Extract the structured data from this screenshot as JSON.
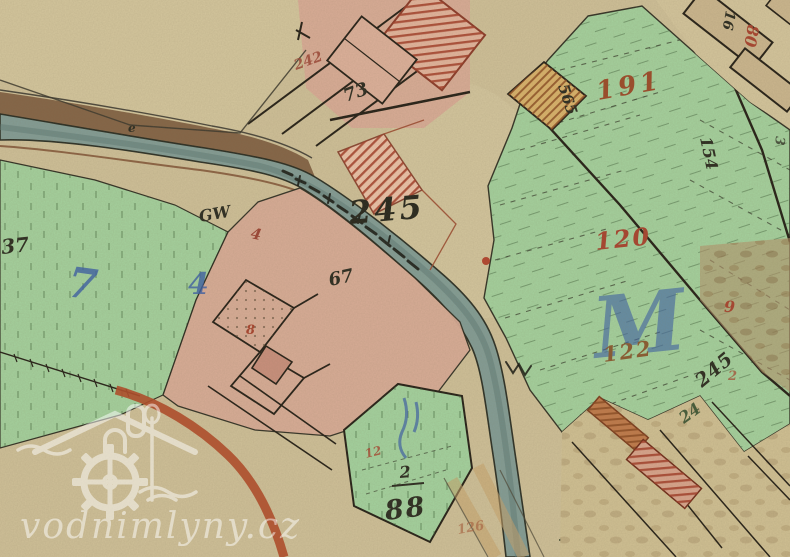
{
  "watermark": {
    "text": "vodnimlyny.cz",
    "icon": "watermill-logo"
  },
  "palette": {
    "paper": "#cfc098",
    "paper_light": "#d6c9a0",
    "meadow_green": "#a3d29e",
    "farm_pink": "#d9ab96",
    "building_pink": "#e3b49c",
    "stream_teal": "#7e9b95",
    "road_brown": "#7b5a3d",
    "road_red": "#b14a28",
    "barn_tan": "#cbb68e",
    "hatch_red": "#a33d28",
    "hatch_orange": "#8a4a20",
    "ink_black": "#2b2b20",
    "ink_red": "#a8432e",
    "ink_brown": "#8a5a30",
    "ink_blue": "#3a5fa8",
    "ink_green": "#2c4a2a"
  },
  "labels": [
    {
      "name": "parcel-245-center",
      "text": "245",
      "x": 350,
      "y": 224,
      "size": 32,
      "color": "#26261c",
      "rot": -5,
      "spacing": 3
    },
    {
      "name": "house-73",
      "text": "73",
      "x": 346,
      "y": 102,
      "size": 18,
      "color": "#2b2b20",
      "rot": -20
    },
    {
      "name": "red-242",
      "text": "242",
      "x": 296,
      "y": 70,
      "size": 14,
      "color": "#9c4434",
      "rot": -20,
      "opacity": 0.85
    },
    {
      "name": "building-565",
      "text": "565",
      "x": 558,
      "y": 86,
      "size": 15,
      "color": "#2b2b20",
      "rot": 72
    },
    {
      "name": "corner-16",
      "text": "16",
      "x": 726,
      "y": 10,
      "size": 14,
      "color": "#2b2b20",
      "rot": 100
    },
    {
      "name": "red-80",
      "text": "80",
      "x": 748,
      "y": 24,
      "size": 16,
      "color": "#a8432e",
      "rot": 100
    },
    {
      "name": "parcel-191",
      "text": "191",
      "x": 598,
      "y": 100,
      "size": 26,
      "color": "#9c4a28",
      "rot": -10,
      "spacing": 4
    },
    {
      "name": "parcel-154",
      "text": "154",
      "x": 700,
      "y": 138,
      "size": 16,
      "color": "#2b2b20",
      "rot": 78
    },
    {
      "name": "edge-3",
      "text": "3",
      "x": 776,
      "y": 136,
      "size": 13,
      "color": "#2b2b20",
      "rot": 95,
      "opacity": 0.75
    },
    {
      "name": "parcel-120",
      "text": "120",
      "x": 596,
      "y": 250,
      "size": 24,
      "color": "#a8432e",
      "rot": -6,
      "spacing": 2
    },
    {
      "name": "blue-script-M",
      "text": "M",
      "x": 596,
      "y": 358,
      "size": 84,
      "color": "#3a5fa8",
      "rot": -6,
      "opacity": 0.6
    },
    {
      "name": "parcel-122",
      "text": "122",
      "x": 604,
      "y": 362,
      "size": 21,
      "color": "#8a5a30",
      "rot": -8,
      "spacing": 2
    },
    {
      "name": "red-9",
      "text": "9",
      "x": 724,
      "y": 312,
      "size": 16,
      "color": "#a8432e",
      "rot": 0
    },
    {
      "name": "red-2-right",
      "text": "2",
      "x": 728,
      "y": 380,
      "size": 13,
      "color": "#a8432e",
      "rot": 0,
      "opacity": 0.7
    },
    {
      "name": "parcel-245-lower",
      "text": "245",
      "x": 702,
      "y": 388,
      "size": 19,
      "color": "#2b2b20",
      "rot": -40,
      "spacing": 1
    },
    {
      "name": "green-script-24",
      "text": "24",
      "x": 684,
      "y": 424,
      "size": 16,
      "color": "#2c4a2a",
      "rot": -36,
      "opacity": 0.85
    },
    {
      "name": "left-37",
      "text": "37",
      "x": 2,
      "y": 254,
      "size": 20,
      "color": "#2b2b20",
      "rot": -6
    },
    {
      "name": "blue-7",
      "text": "7",
      "x": 66,
      "y": 296,
      "size": 42,
      "color": "#3a5fa8",
      "rot": 8,
      "opacity": 0.8
    },
    {
      "name": "blue-4-left",
      "text": "4",
      "x": 188,
      "y": 294,
      "size": 30,
      "color": "#3a5fa8",
      "rot": 0,
      "opacity": 0.8
    },
    {
      "name": "mark-GW",
      "text": "GW",
      "x": 200,
      "y": 222,
      "size": 16,
      "color": "#2b2b20",
      "rot": -10
    },
    {
      "name": "red-4",
      "text": "4",
      "x": 250,
      "y": 238,
      "size": 15,
      "color": "#9c4434",
      "rot": 12
    },
    {
      "name": "farm-67",
      "text": "67",
      "x": 330,
      "y": 286,
      "size": 18,
      "color": "#2b2b20",
      "rot": -12
    },
    {
      "name": "red-8",
      "text": "8",
      "x": 246,
      "y": 334,
      "size": 13,
      "color": "#a8432e",
      "rot": 0
    },
    {
      "name": "red-12",
      "text": "12",
      "x": 366,
      "y": 458,
      "size": 12,
      "color": "#a8432e",
      "rot": -14,
      "opacity": 0.8
    },
    {
      "name": "num-2-over-88",
      "text": "2",
      "x": 400,
      "y": 478,
      "size": 16,
      "color": "#2b2b20",
      "rot": -5
    },
    {
      "name": "parcel-88",
      "text": "88",
      "x": 386,
      "y": 520,
      "size": 27,
      "color": "#2b2b20",
      "rot": -7,
      "spacing": 2
    },
    {
      "name": "faint-126",
      "text": "126",
      "x": 458,
      "y": 534,
      "size": 13,
      "color": "#a85b3a",
      "rot": -10,
      "opacity": 0.6
    },
    {
      "name": "boundary-hook",
      "text": "e",
      "x": 128,
      "y": 132,
      "size": 12,
      "color": "#2b2b20",
      "rot": 0
    }
  ]
}
